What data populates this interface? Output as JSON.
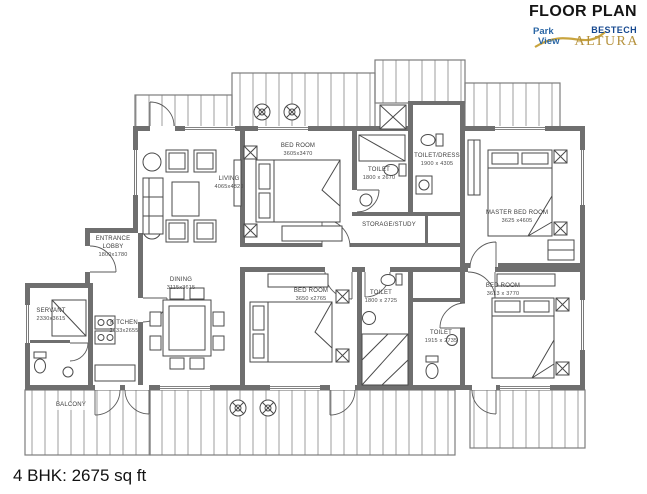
{
  "title": "FLOOR PLAN",
  "logo": {
    "park": "Park",
    "view": "View",
    "brand": "BESTECH",
    "project": "ALTURA"
  },
  "footer": {
    "area": "4 BHK: 2675 sq ft"
  },
  "colors": {
    "wall": "#6f6f6f",
    "drawing_line": "#4a4a4a",
    "hatch_line": "#9c9c9c",
    "brand_blue": "#2a66a5",
    "brand_dark_blue": "#16488f",
    "brand_gold": "#b5913c",
    "label_text": "#3c3c3c",
    "background": "#ffffff"
  },
  "rooms": [
    {
      "name": "LIVING",
      "dims": "4065x4820"
    },
    {
      "name": "BED ROOM",
      "dims": "3605x3470"
    },
    {
      "name": "TOILET",
      "dims": "1800 x 2670"
    },
    {
      "name": "TOILET/DRESS",
      "dims": "1900 x 4305"
    },
    {
      "name": "MASTER BED ROOM",
      "dims": "3625 x4605"
    },
    {
      "name": "STORAGE/STUDY",
      "dims": ""
    },
    {
      "name": "ENTRANCE LOBBY",
      "dims": "1800x1780"
    },
    {
      "name": "DINING",
      "dims": "3115x3615"
    },
    {
      "name": "SERVANT",
      "dims": "2330x3615"
    },
    {
      "name": "KITCHEN",
      "dims": "2433x2655"
    },
    {
      "name": "BED ROOM",
      "dims": "3650 x2765"
    },
    {
      "name": "TOILET",
      "dims": "1800 x 2725"
    },
    {
      "name": "TOILET",
      "dims": "1915 x 2735"
    },
    {
      "name": "BED ROOM",
      "dims": "3613 x 3770"
    },
    {
      "name": "BALCONY",
      "dims": ""
    }
  ]
}
